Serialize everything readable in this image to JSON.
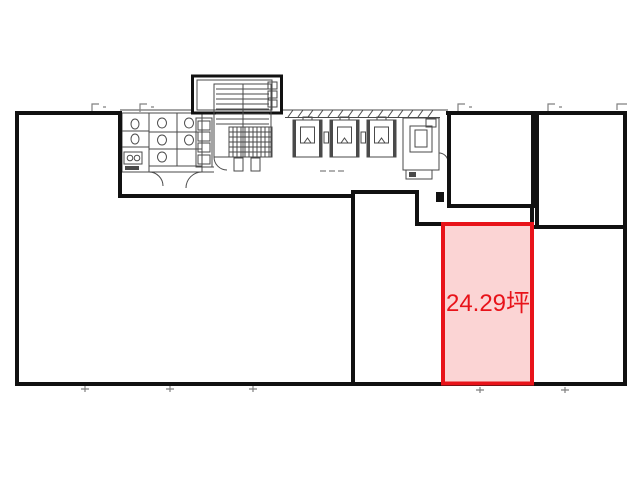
{
  "floor_plan": {
    "highlighted_unit": {
      "area_label": "24.29坪"
    }
  },
  "colors": {
    "wall": "#111111",
    "detail_line": "#4a4a4a",
    "tick": "#808080",
    "highlight_border": "#e8131a",
    "highlight_fill": "#fbd4d4",
    "highlight_text": "#e8131a",
    "background": "#ffffff"
  }
}
